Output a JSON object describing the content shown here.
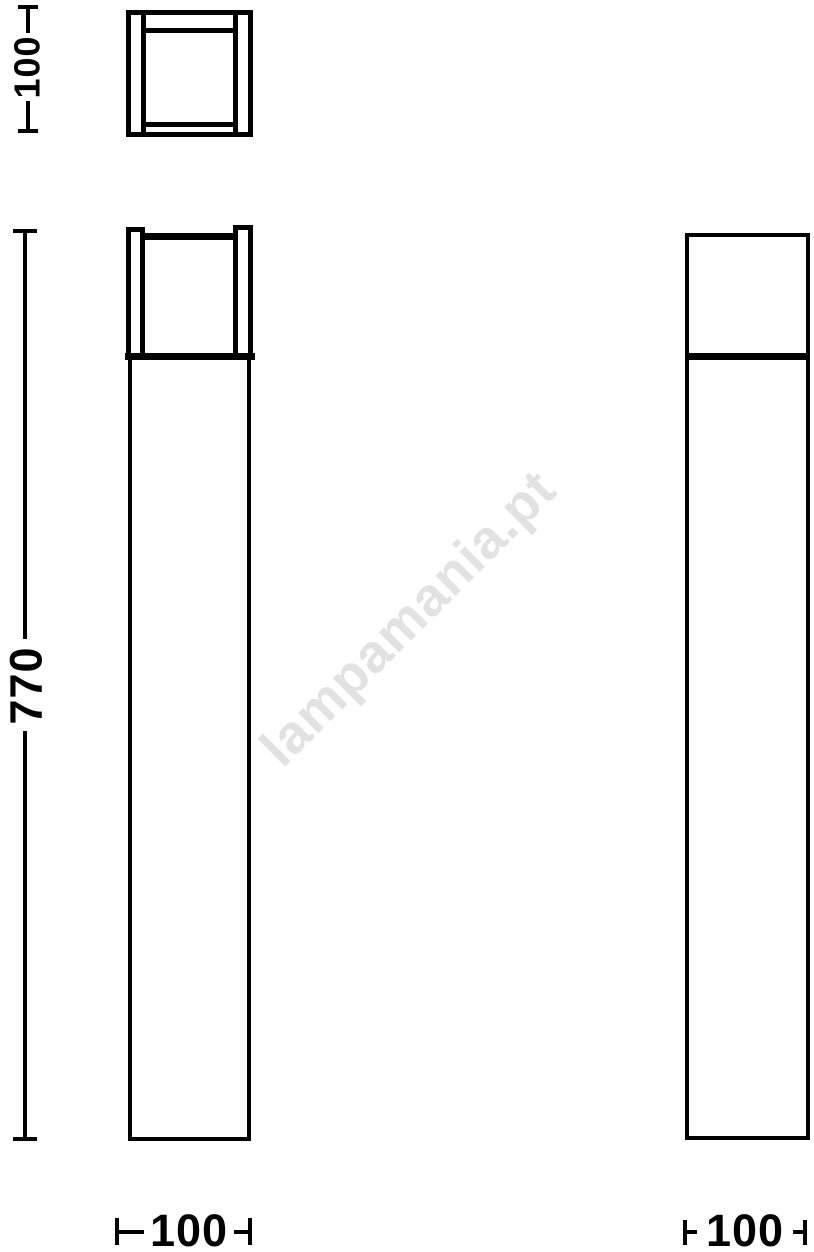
{
  "colors": {
    "line": "#000000",
    "watermark": "#e2e2e2",
    "background": "#ffffff"
  },
  "watermark": {
    "text": "lampamania.pt"
  },
  "dimensions": {
    "top_view_height": {
      "value": "100"
    },
    "overall_height": {
      "value": "770"
    },
    "front_width": {
      "value": "100"
    },
    "side_width": {
      "value": "100"
    }
  }
}
